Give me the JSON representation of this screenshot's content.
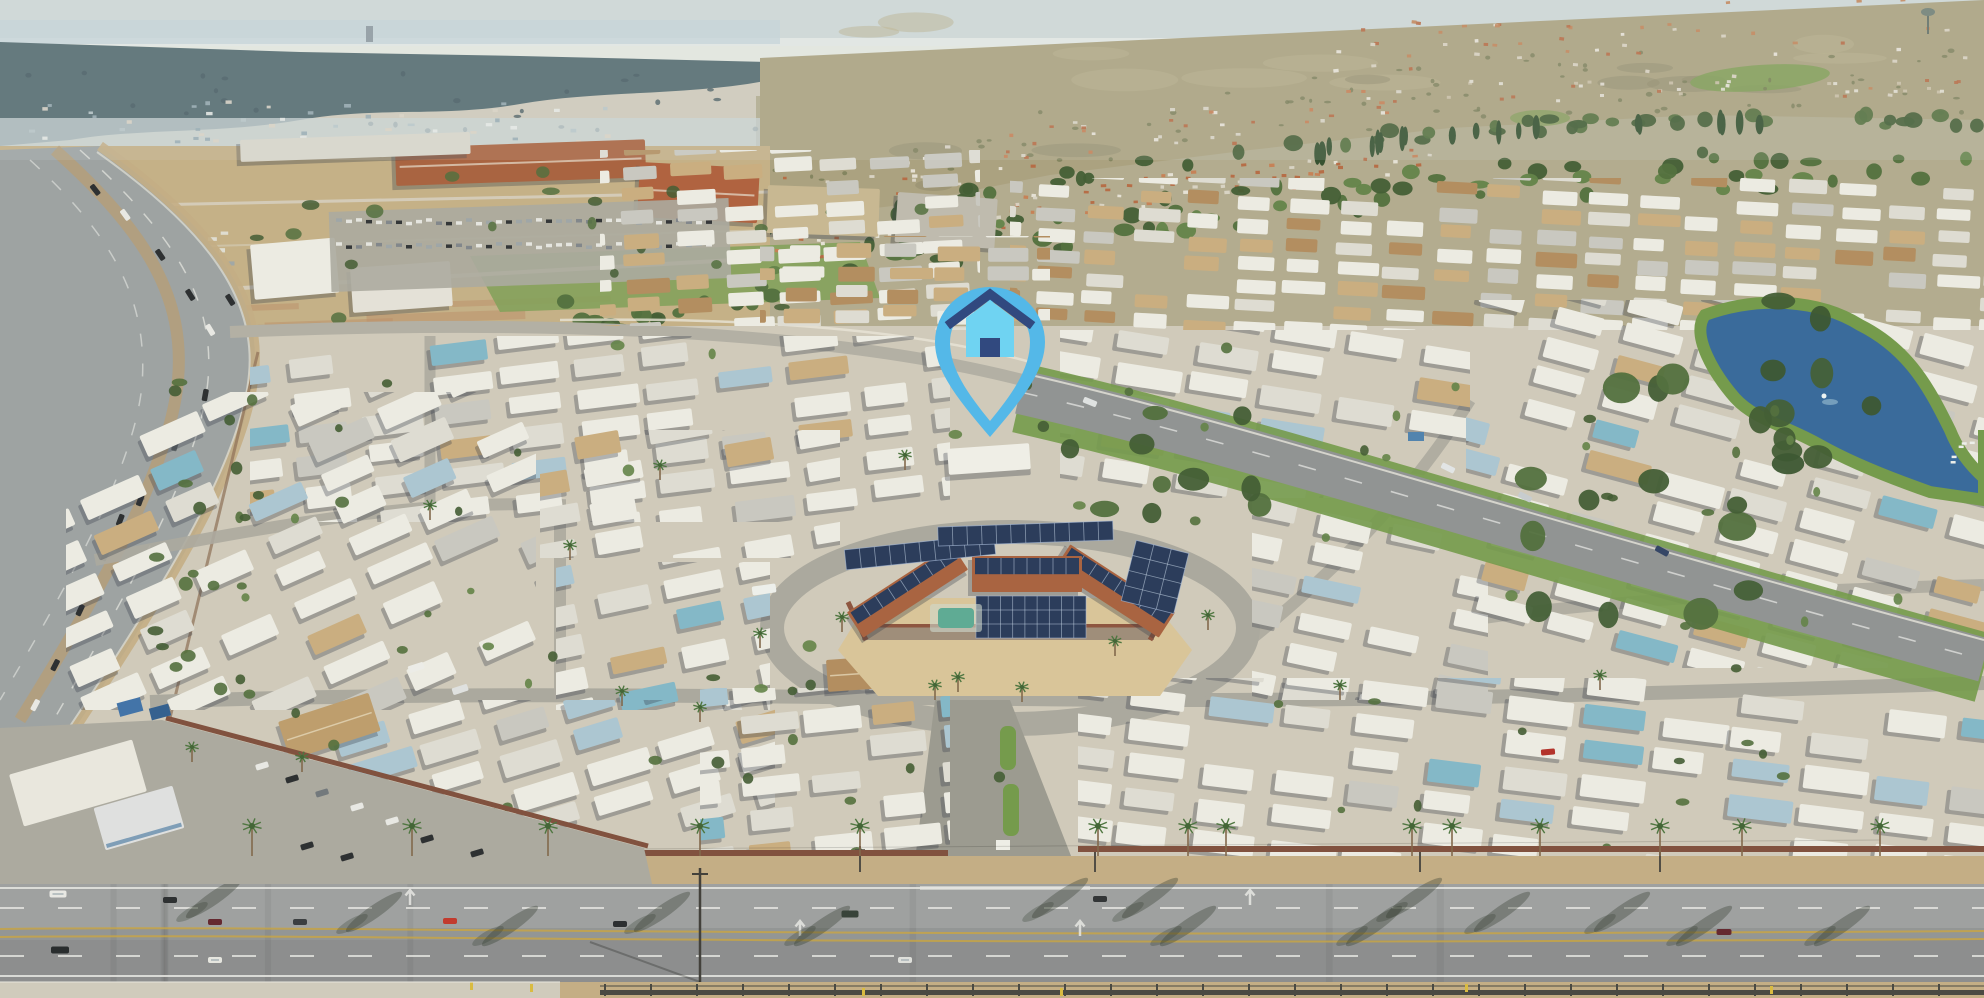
{
  "scene": {
    "type": "aerial-photograph",
    "subject": "Aerial view of a large mobile home park community beside a freeway and boulevard, with distant hills, a lagoon and a solar-paneled clubhouse",
    "time_of_day": "day"
  },
  "marker": {
    "icon": "house-location-pin",
    "style": "outlined teardrop pin with house glyph",
    "position": {
      "x": 990,
      "y": 360,
      "tip_y": 437
    },
    "colors": {
      "pin": "#54b8e8",
      "house_body": "#6fd3f2",
      "roof": "#31497f",
      "door": "#31497f"
    }
  },
  "palette": {
    "sky1": "#cdd7d9",
    "sky2": "#e6eae7",
    "ocean": "#c2d2da",
    "mesa": "#4d656d",
    "mesaShadow": "#3e545c",
    "haze": "#c8d3d6",
    "hill": "#a89f7e",
    "hillLight": "#b7ae8a",
    "hillShadow": "#8a8266",
    "hillGreen": "#7c9a52",
    "field": "#c3ae85",
    "fieldGreen": "#7f9f58",
    "dirtRed": "#b98a66",
    "scrub": "#6d744e",
    "treeDark": "#3c572f",
    "treeMid": "#4c6a39",
    "treeLight": "#5d7e44",
    "cypress": "#2e4a2b",
    "ground": "#cfc9bb",
    "street": "#a8a69e",
    "streetLight": "#b6b3ab",
    "homeWhite": "#ecebe5",
    "homeWhite2": "#dedcd4",
    "homeGray": "#c8c7c1",
    "homeBlue": "#a9c4d3",
    "homeTeal": "#7fb6c9",
    "homeTan": "#c9ab7e",
    "homeBrown": "#b08a5c",
    "shadow": "rgba(45,50,65,0.32)",
    "terra": "#a65d3b",
    "terraDark": "#8c4a2f",
    "solar": "#223457",
    "solarLine": "#9fb4d6",
    "sand": "#d8c398",
    "stone": "#9b8a78",
    "wallBrown": "#8a4f3a",
    "pool": "#58a893",
    "fence": "#7c4a39",
    "blvd": "#8f9294",
    "blvdLight": "#9b9ea0",
    "blvdDark": "#87898c",
    "lane": "#e8e8e6",
    "yellowLine": "#c8a23c",
    "sidewalk": "#cfcabd",
    "dirt": "#c2ab83",
    "darkFence": "#42423e",
    "lawn": "#6f9747",
    "lake": "#31659a",
    "asphalt": "#9aa0a2",
    "shoulder": "#c2ab83",
    "guard": "#d8d8d2",
    "carDark": "#24272c",
    "carWhite": "#e8e8e6",
    "carRed": "#c03228",
    "pole": "#4a4640",
    "yellow": "#d8b93c",
    "lotGray": "#a9a79f"
  }
}
